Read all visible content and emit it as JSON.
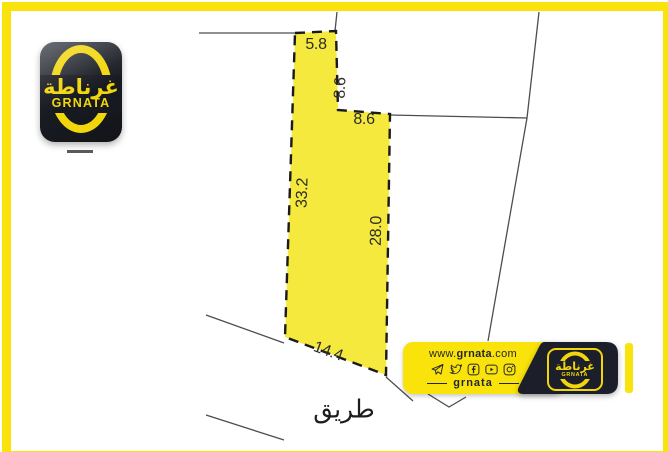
{
  "colors": {
    "frame_yellow": "#FAE30A",
    "plot_yellow": "#F4E93C",
    "logo_yellow": "#F2D60C",
    "banner_black": "#1C1F29",
    "ink": "#23262E",
    "parcel_line_gray": "#4D4D4D"
  },
  "logo": {
    "arabic": "غرناطة",
    "latin": "GRNATA"
  },
  "plot": {
    "dimensions": {
      "top": "5.8",
      "neck": "8.6",
      "step": "8.6",
      "left": "33.2",
      "right": "28.0",
      "bottom": "14.4"
    },
    "road_label": "طريق"
  },
  "banner": {
    "website_prefix": "www.",
    "website_name": "grnata",
    "website_suffix": ".com",
    "handle": "grnata",
    "social_icons": [
      "telegram-icon",
      "twitter-icon",
      "facebook-icon",
      "youtube-icon",
      "instagram-icon"
    ]
  }
}
